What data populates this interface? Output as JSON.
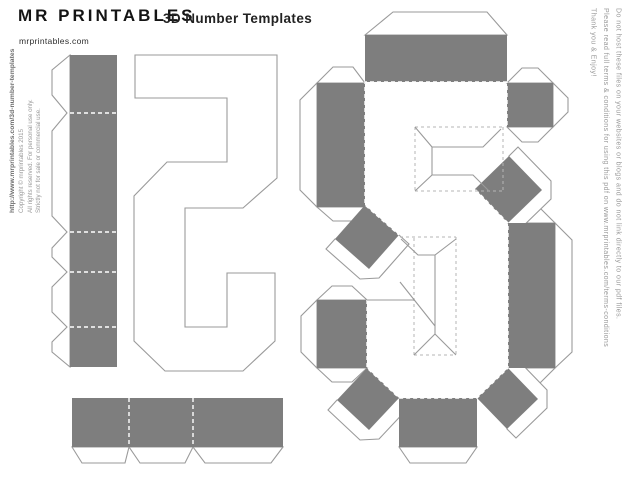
{
  "header": {
    "logo": "MR PRINTABLES",
    "website": "mrprintables.com",
    "title": "3D Number Templates"
  },
  "left_legal": {
    "url": "http://www.mrprintables.com/3d-number-templates",
    "copyright": "Copyright © mrprintables  2015",
    "rights": "All rights reserved. For personal use only.",
    "restriction": "Strictly not for sale or commercial use."
  },
  "right_instructions": {
    "line1": "Do not host these files on your websites or blogs and do not link directly to our pdf files.",
    "line2": "Please read full terms & conditions for using this pdf on www.mrprintables.com/terms-conditions",
    "line3": "Thank you & Enjoy!"
  },
  "template": {
    "number": "5",
    "pieces": [
      "side-strip-left",
      "side-strip-bottom",
      "back-face-mirrored-5",
      "front-face-5-with-tabs"
    ],
    "colors": {
      "tab_gray": "#7e7e7e",
      "outline_gray": "#9a9a9a",
      "fold_dash_on_white": "#b5b5b5",
      "fold_dash_on_gray": "#ffffff",
      "text_dark": "#141414",
      "text_gray": "#9a9a9a"
    }
  }
}
